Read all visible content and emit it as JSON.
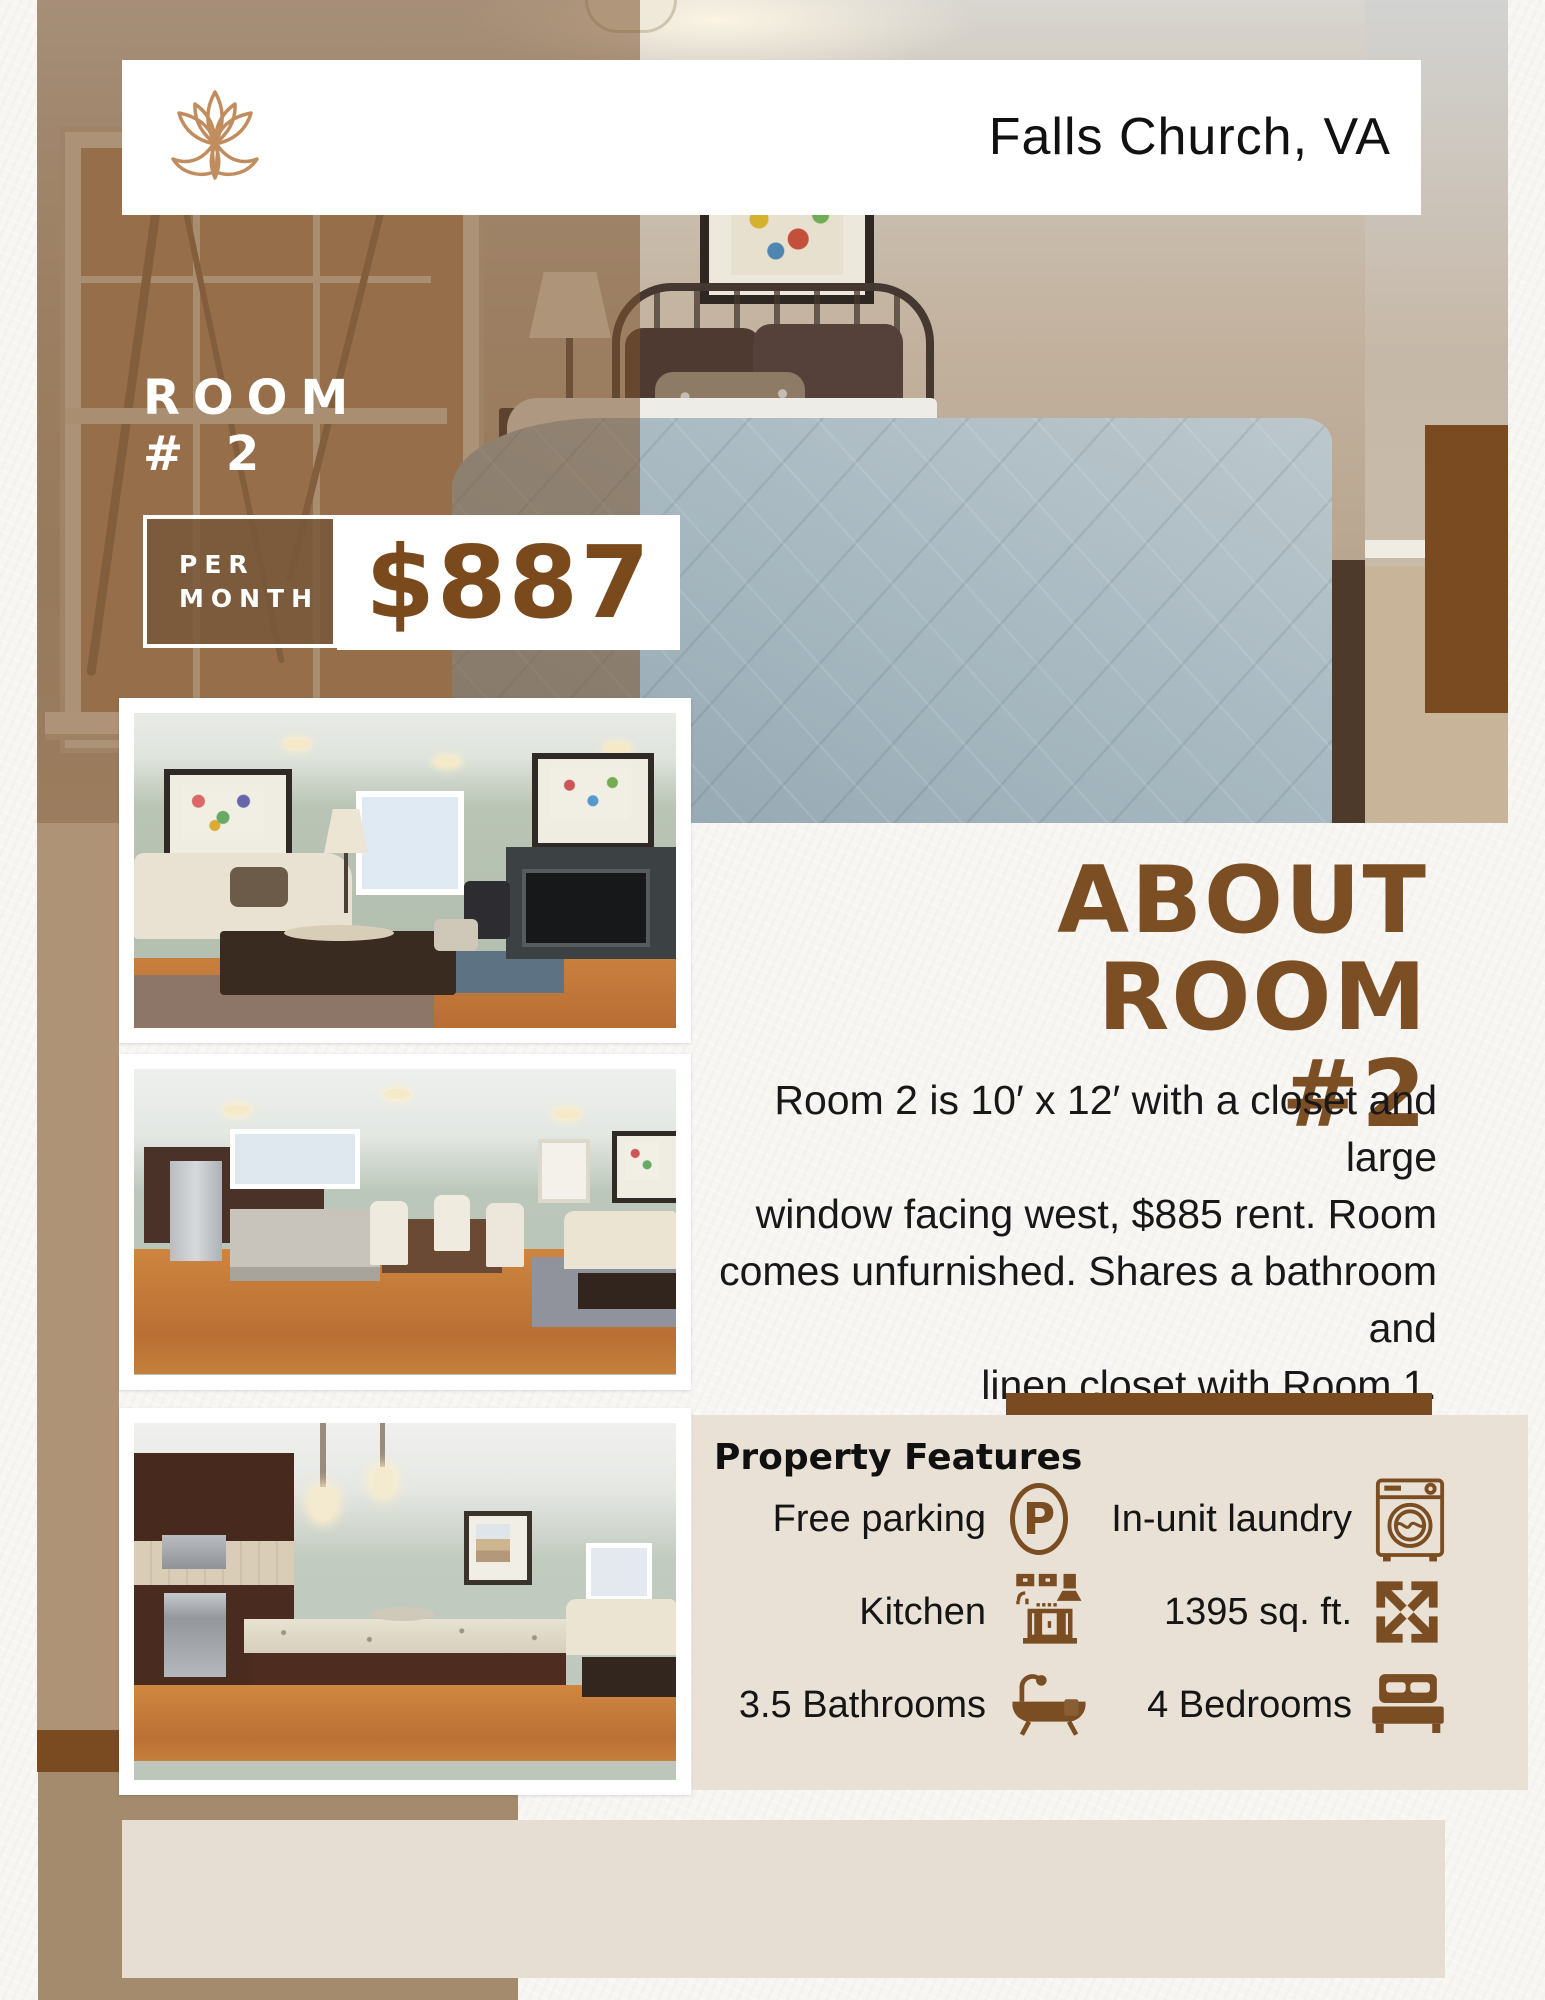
{
  "header": {
    "location": "Falls Church, VA",
    "logo": "lotus-logo"
  },
  "hero": {
    "room_line1": "ROOM",
    "room_line2": "# 2",
    "price_label_line1": "PER",
    "price_label_line2": "MONTH",
    "price": "$887"
  },
  "about": {
    "title_line1": "ABOUT ROOM",
    "title_line2": "#2",
    "description_lines": [
      "Room 2 is 10′ x 12′ with a closet and large",
      "window facing west, $885 rent. Room",
      "comes unfurnished. Shares a bathroom and",
      "linen closet with Room 1."
    ]
  },
  "features": {
    "heading": "Property Features",
    "parking_letter": "P",
    "items": [
      {
        "label": "Free parking",
        "icon": "parking-icon"
      },
      {
        "label": "In-unit laundry",
        "icon": "laundry-icon"
      },
      {
        "label": "Kitchen",
        "icon": "kitchen-icon"
      },
      {
        "label": "1395 sq. ft.",
        "icon": "area-icon"
      },
      {
        "label": "3.5 Bathrooms",
        "icon": "bathtub-icon"
      },
      {
        "label": "4 Bedrooms",
        "icon": "bed-icon"
      }
    ]
  },
  "colors": {
    "accent_brown": "#7a4a1f",
    "logo_tan": "#c18d5f",
    "panel_beige": "#e9e1d5",
    "tan_block": "#a48b6e",
    "photo_overlay": "rgba(124,83,48,0.55)"
  }
}
